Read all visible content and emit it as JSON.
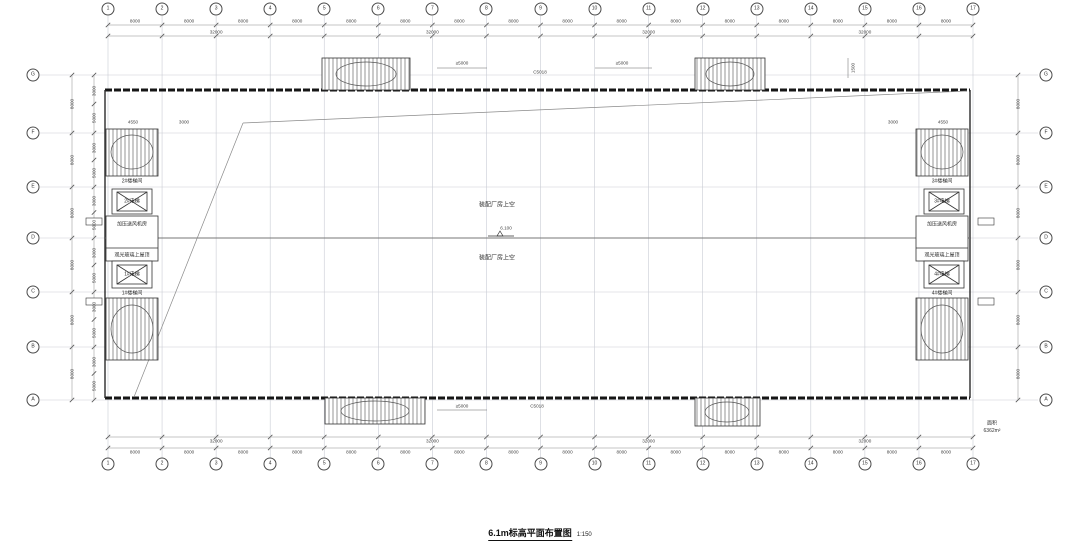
{
  "title": {
    "text": "6.1m标高平面布置图",
    "scale": "1:150"
  },
  "axes": {
    "cols": [
      "1",
      "2",
      "3",
      "4",
      "5",
      "6",
      "7",
      "8",
      "9",
      "10",
      "11",
      "12",
      "13",
      "14",
      "15",
      "16",
      "17"
    ],
    "rows": [
      "G",
      "F",
      "E",
      "D",
      "C",
      "B",
      "A"
    ]
  },
  "dims": {
    "bays": [
      "8000",
      "8000",
      "8000",
      "8000",
      "8000",
      "8000",
      "8000",
      "8000",
      "8000",
      "8000",
      "8000",
      "8000",
      "8000",
      "8000",
      "8000",
      "8000"
    ],
    "totals": [
      "32000",
      "32000",
      "32000",
      "32000"
    ],
    "row_bays": [
      "8000",
      "8000",
      "8000",
      "8000",
      "8000",
      "8000"
    ],
    "row_subs": [
      "3000",
      "5000"
    ],
    "side_note": "1500"
  },
  "rooms": {
    "left": {
      "stair_top": "2#楼梯间",
      "elev_top": "2#电梯",
      "fan": "加压送风机房",
      "glass": "观光玻璃上屋顶",
      "elev_bottom": "1#电梯",
      "stair_bottom": "1#楼梯间"
    },
    "right": {
      "stair_top": "3#楼梯间",
      "elev_top": "3#电梯",
      "fan": "加压送风机房",
      "glass": "观光玻璃上屋顶",
      "elev_bottom": "4#电梯",
      "stair_bottom": "4#楼梯间"
    }
  },
  "center": {
    "hall_upper": "装配厂房上空",
    "hall_lower": "装配厂房上空",
    "elevation": "6.100"
  },
  "annotations": {
    "top_left": "≥5000",
    "top_center": "C5018",
    "top_right": "≥5000",
    "bottom_left": "≥5000",
    "bottom_center": "C5018",
    "corner_dims": [
      "4550",
      "3000"
    ]
  },
  "notes": {
    "area_label": "面积",
    "area_value": "6362m²"
  }
}
